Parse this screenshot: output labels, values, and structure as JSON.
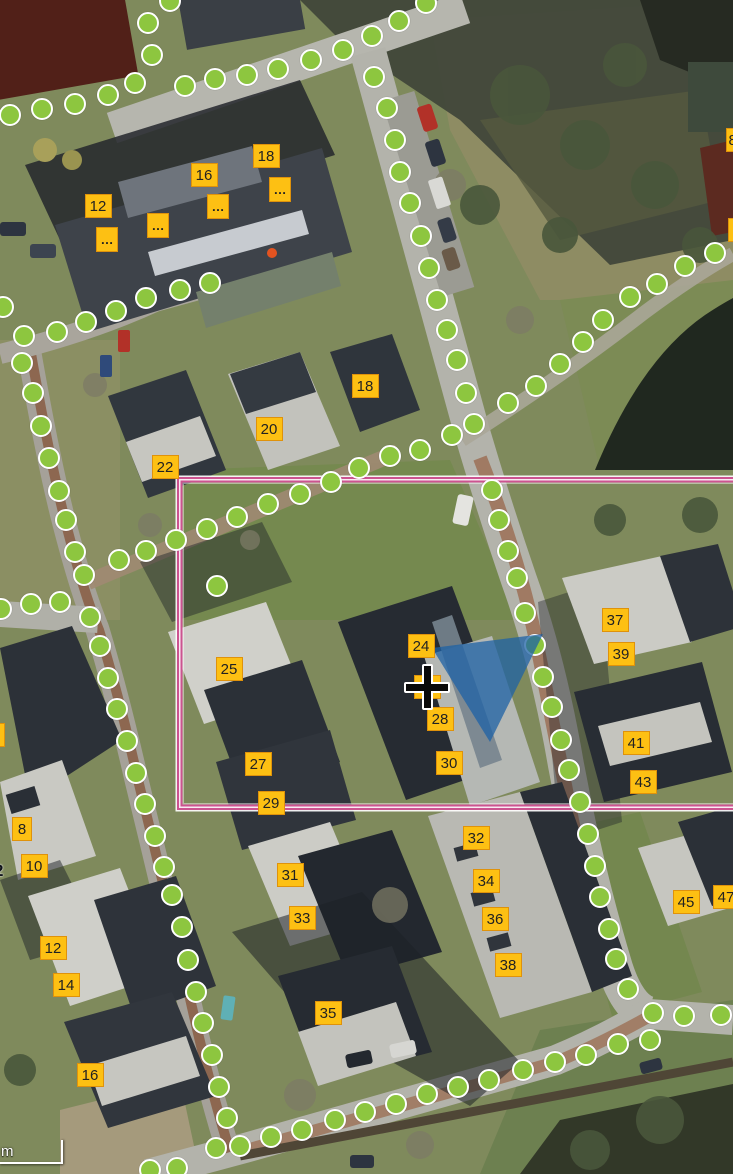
{
  "map": {
    "scale_bar": {
      "label": "m"
    },
    "colors": {
      "route_dot_fill": "#8dc63f",
      "route_dot_stroke": "#ffffff",
      "label_fill": "#fdc013",
      "label_border": "#df920b",
      "label_text": "#222222",
      "selection_outline": "#cc5390",
      "highlight_fill": "#1e62a6",
      "crosshair_black": "#0a0a0a",
      "crosshair_white": "#ffffff"
    },
    "selection_rectangle": {
      "x": 177,
      "y": 477,
      "width": 576,
      "height": 333
    },
    "highlight_polygon": {
      "points": "432,648 543,634 490,742",
      "opacity": 0.75
    },
    "crosshair_position": {
      "x": 427,
      "y": 687
    },
    "house_number_labels": [
      {
        "t": "12",
        "x": 98,
        "y": 206
      },
      {
        "t": "16",
        "x": 204,
        "y": 175
      },
      {
        "t": "18",
        "x": 266,
        "y": 156
      },
      {
        "t": "18",
        "x": 365,
        "y": 386
      },
      {
        "t": "20",
        "x": 269,
        "y": 429
      },
      {
        "t": "22",
        "x": 165,
        "y": 467
      },
      {
        "t": "24",
        "x": 421,
        "y": 646
      },
      {
        "t": "25",
        "x": 229,
        "y": 669
      },
      {
        "t": "26",
        "x": 427,
        "y": 687
      },
      {
        "t": "27",
        "x": 258,
        "y": 764
      },
      {
        "t": "28",
        "x": 440,
        "y": 719
      },
      {
        "t": "29",
        "x": 271,
        "y": 803
      },
      {
        "t": "30",
        "x": 449,
        "y": 763
      },
      {
        "t": "31",
        "x": 290,
        "y": 875
      },
      {
        "t": "32",
        "x": 476,
        "y": 838
      },
      {
        "t": "33",
        "x": 302,
        "y": 918
      },
      {
        "t": "34",
        "x": 486,
        "y": 881
      },
      {
        "t": "35",
        "x": 328,
        "y": 1013
      },
      {
        "t": "36",
        "x": 495,
        "y": 919
      },
      {
        "t": "37",
        "x": 615,
        "y": 620
      },
      {
        "t": "38",
        "x": 508,
        "y": 965
      },
      {
        "t": "39",
        "x": 621,
        "y": 654
      },
      {
        "t": "41",
        "x": 636,
        "y": 743
      },
      {
        "t": "43",
        "x": 643,
        "y": 782
      },
      {
        "t": "45",
        "x": 686,
        "y": 902
      },
      {
        "t": "47",
        "x": 726,
        "y": 897
      },
      {
        "t": "8",
        "x": 22,
        "y": 829,
        "w": 20
      },
      {
        "t": "10",
        "x": 34,
        "y": 866
      },
      {
        "t": "12",
        "x": 53,
        "y": 948
      },
      {
        "t": "14",
        "x": 66,
        "y": 985
      },
      {
        "t": "16",
        "x": 90,
        "y": 1075
      },
      {
        "t": "8",
        "x": 739,
        "y": 140,
        "align": "left"
      },
      {
        "t": "",
        "x": 741,
        "y": 230
      },
      {
        "t": "",
        "x": -9,
        "y": 735
      }
    ],
    "ellipsis_labels": [
      {
        "t": "…",
        "x": 107,
        "y": 239
      },
      {
        "t": "…",
        "x": 158,
        "y": 225
      },
      {
        "t": "…",
        "x": 218,
        "y": 206
      },
      {
        "t": "…",
        "x": 280,
        "y": 189
      }
    ],
    "plain_text_labels": [
      {
        "t": "2",
        "x": -6,
        "y": 861
      }
    ],
    "route_dots": [
      [
        170,
        1
      ],
      [
        148,
        23
      ],
      [
        152,
        55
      ],
      [
        135,
        83
      ],
      [
        108,
        95
      ],
      [
        75,
        104
      ],
      [
        42,
        109
      ],
      [
        10,
        115
      ],
      [
        185,
        86
      ],
      [
        215,
        79
      ],
      [
        247,
        75
      ],
      [
        278,
        69
      ],
      [
        311,
        60
      ],
      [
        343,
        50
      ],
      [
        372,
        36
      ],
      [
        399,
        21
      ],
      [
        426,
        3
      ],
      [
        374,
        77
      ],
      [
        387,
        108
      ],
      [
        395,
        140
      ],
      [
        400,
        172
      ],
      [
        410,
        203
      ],
      [
        421,
        236
      ],
      [
        429,
        268
      ],
      [
        437,
        300
      ],
      [
        447,
        330
      ],
      [
        457,
        360
      ],
      [
        466,
        393
      ],
      [
        474,
        424
      ],
      [
        452,
        435
      ],
      [
        420,
        450
      ],
      [
        390,
        456
      ],
      [
        359,
        468
      ],
      [
        331,
        482
      ],
      [
        300,
        494
      ],
      [
        268,
        504
      ],
      [
        237,
        517
      ],
      [
        207,
        529
      ],
      [
        176,
        540
      ],
      [
        146,
        551
      ],
      [
        119,
        560
      ],
      [
        84,
        575
      ],
      [
        508,
        403
      ],
      [
        536,
        386
      ],
      [
        560,
        364
      ],
      [
        583,
        342
      ],
      [
        603,
        320
      ],
      [
        630,
        297
      ],
      [
        657,
        284
      ],
      [
        685,
        266
      ],
      [
        715,
        253
      ],
      [
        492,
        490
      ],
      [
        499,
        520
      ],
      [
        508,
        551
      ],
      [
        517,
        578
      ],
      [
        525,
        613
      ],
      [
        535,
        645
      ],
      [
        543,
        677
      ],
      [
        552,
        707
      ],
      [
        561,
        740
      ],
      [
        569,
        770
      ],
      [
        580,
        802
      ],
      [
        588,
        834
      ],
      [
        595,
        866
      ],
      [
        600,
        897
      ],
      [
        609,
        929
      ],
      [
        616,
        959
      ],
      [
        628,
        989
      ],
      [
        653,
        1013
      ],
      [
        684,
        1016
      ],
      [
        721,
        1015
      ],
      [
        650,
        1040
      ],
      [
        618,
        1044
      ],
      [
        586,
        1055
      ],
      [
        555,
        1062
      ],
      [
        523,
        1070
      ],
      [
        489,
        1080
      ],
      [
        458,
        1087
      ],
      [
        427,
        1094
      ],
      [
        396,
        1104
      ],
      [
        365,
        1112
      ],
      [
        335,
        1120
      ],
      [
        302,
        1130
      ],
      [
        271,
        1137
      ],
      [
        240,
        1146
      ],
      [
        216,
        1148
      ],
      [
        3,
        307
      ],
      [
        24,
        336
      ],
      [
        22,
        363
      ],
      [
        33,
        393
      ],
      [
        41,
        426
      ],
      [
        49,
        458
      ],
      [
        59,
        491
      ],
      [
        66,
        520
      ],
      [
        75,
        552
      ],
      [
        90,
        617
      ],
      [
        100,
        646
      ],
      [
        108,
        678
      ],
      [
        117,
        709
      ],
      [
        127,
        741
      ],
      [
        136,
        773
      ],
      [
        145,
        804
      ],
      [
        155,
        836
      ],
      [
        164,
        867
      ],
      [
        172,
        895
      ],
      [
        182,
        927
      ],
      [
        188,
        960
      ],
      [
        196,
        992
      ],
      [
        203,
        1023
      ],
      [
        212,
        1055
      ],
      [
        219,
        1087
      ],
      [
        227,
        1118
      ],
      [
        177,
        1168
      ],
      [
        150,
        1170
      ],
      [
        1,
        609
      ],
      [
        31,
        604
      ],
      [
        60,
        602
      ],
      [
        217,
        586
      ],
      [
        210,
        283
      ],
      [
        180,
        290
      ],
      [
        146,
        298
      ],
      [
        116,
        311
      ],
      [
        86,
        322
      ],
      [
        57,
        332
      ]
    ]
  }
}
